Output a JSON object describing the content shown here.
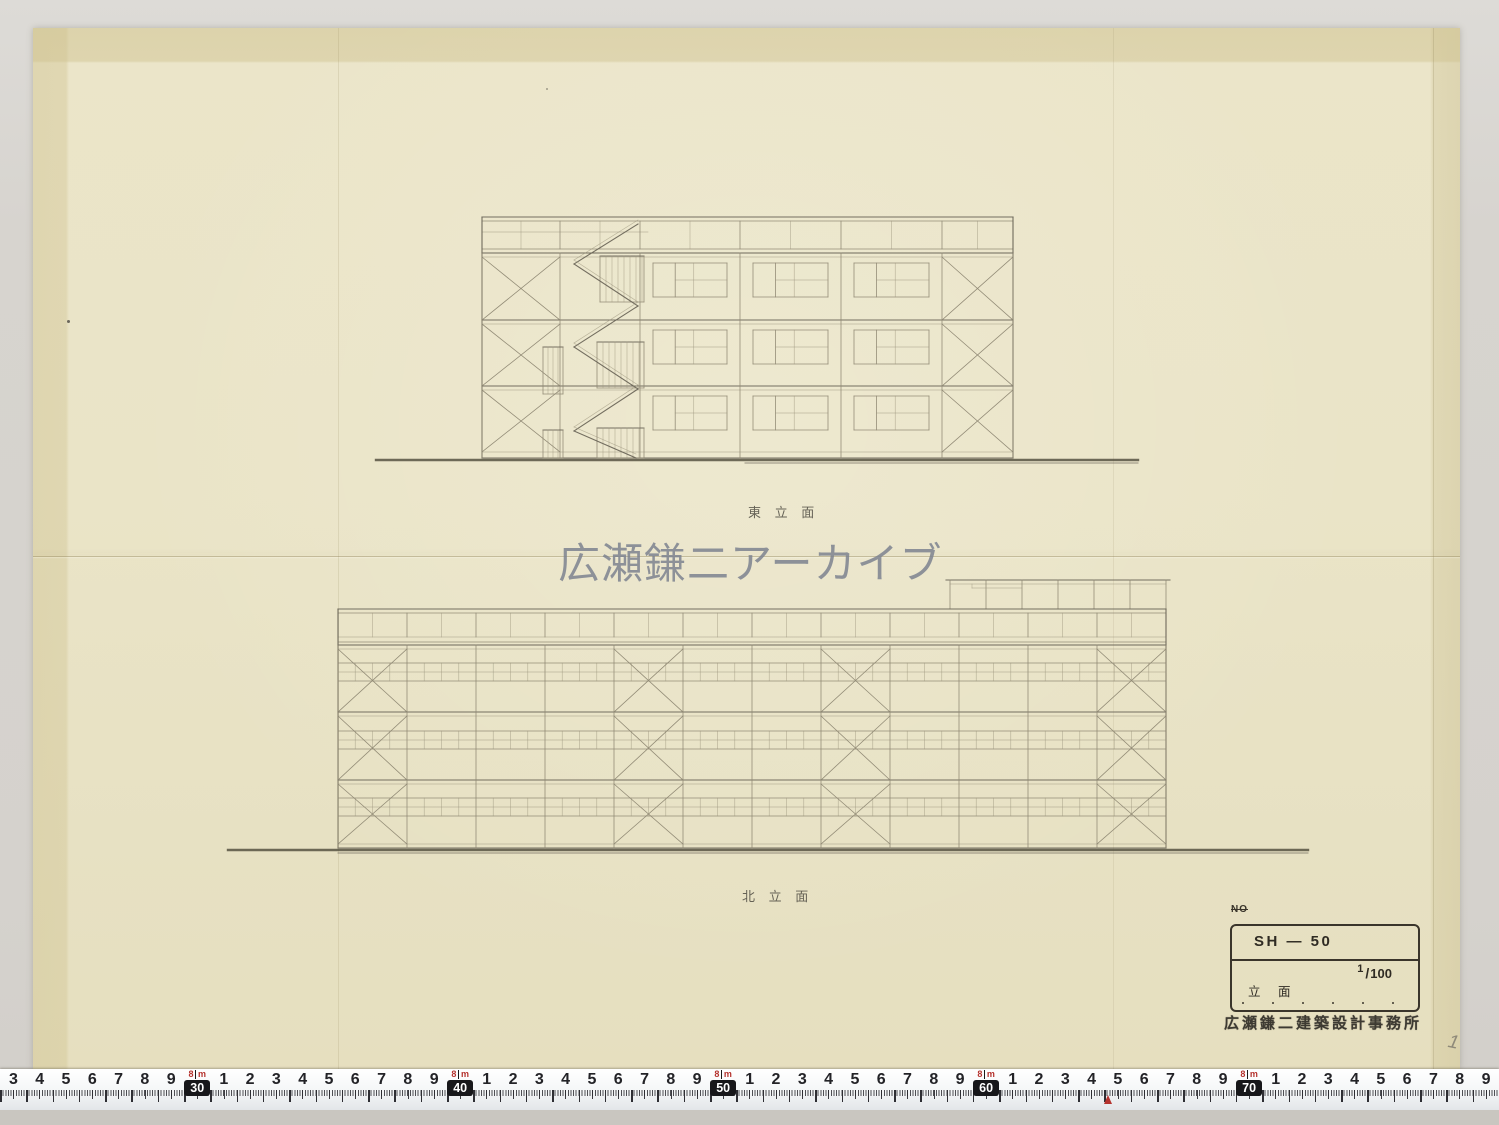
{
  "watermark": {
    "text": "広瀬鎌二アーカイブ"
  },
  "colors": {
    "paper": "#eae4c7",
    "scan_background": "#d7d4cf",
    "pencil_line": "#8e8773",
    "ink": "#3a352b",
    "tape_red": "#b5332e",
    "tape_black": "#17171a"
  },
  "elevations": {
    "east": {
      "label": "東 立 面",
      "left": 482,
      "right": 1013,
      "parapet": {
        "top": 217,
        "top2": 221,
        "mid": 232,
        "midSpan": [
          482,
          648
        ],
        "bot1": 249,
        "bot2": 253
      },
      "beams": [
        253,
        320,
        386
      ],
      "bottomSill": 452,
      "ground": 458,
      "columns": [
        482,
        560,
        640,
        740,
        841,
        942,
        1013
      ],
      "bracedBays": [
        0,
        5
      ],
      "windowBays": [
        2,
        3,
        4
      ],
      "stair": {
        "rails": [
          [
            600,
            256,
            44,
            46
          ],
          [
            597,
            342,
            47,
            46
          ],
          [
            597,
            428,
            47,
            30
          ]
        ],
        "landings": [
          [
            543,
            347,
            20,
            47
          ],
          [
            543,
            430,
            20,
            28
          ]
        ],
        "zigzag": [
          [
            638,
            224
          ],
          [
            574,
            264
          ],
          [
            638,
            306
          ],
          [
            574,
            347
          ],
          [
            638,
            389
          ],
          [
            574,
            431
          ],
          [
            636,
            458
          ]
        ]
      },
      "groundLine": [
        376,
        460,
        1138
      ]
    },
    "north": {
      "label": "北 立 面",
      "left": 338,
      "right": 1166,
      "parapet": {
        "top": 609,
        "top2": 613,
        "rail": 637,
        "bot1": 642,
        "bot2": 645
      },
      "beams": [
        645,
        712,
        780
      ],
      "bottomSill": 844,
      "ground": 848,
      "columns": [
        338,
        407,
        476,
        545,
        614,
        683,
        752,
        821,
        890,
        959,
        1028,
        1097,
        1166
      ],
      "bracedBays": [
        0,
        4,
        7,
        11
      ],
      "ribbons": [
        [
          663,
          681
        ],
        [
          731,
          749
        ],
        [
          798,
          816
        ]
      ],
      "penthouse": {
        "left": 950,
        "right": 1166,
        "top": 580,
        "top2": 584,
        "bottom": 609,
        "cols": [
          950,
          986,
          1022,
          1058,
          1094,
          1130,
          1166
        ],
        "notch": [
          972,
          588,
          1022
        ]
      },
      "groundLine": [
        228,
        850,
        1308
      ]
    }
  },
  "title_block": {
    "no_label": "NO",
    "code": "SH — 50",
    "sheet_title": "立 面",
    "scale_numerator": "1",
    "scale_denominator": "100",
    "stamp": "広瀬鎌二建築設計事務所"
  },
  "page_mark": "1",
  "ruler": {
    "meter_value": "8",
    "meter_unit": "m",
    "cells": [
      "3",
      "4",
      "5",
      "6",
      "7",
      "8",
      "9",
      "M30",
      "1",
      "2",
      "3",
      "4",
      "5",
      "6",
      "7",
      "8",
      "9",
      "M40",
      "1",
      "2",
      "3",
      "4",
      "5",
      "6",
      "7",
      "8",
      "9",
      "M50",
      "1",
      "2",
      "3",
      "4",
      "5",
      "6",
      "7",
      "8",
      "9",
      "M60",
      "1",
      "2",
      "3",
      "4",
      "5",
      "6",
      "7",
      "8",
      "9",
      "M70",
      "1",
      "2",
      "3",
      "4",
      "5",
      "6",
      "7",
      "8",
      "9"
    ]
  }
}
